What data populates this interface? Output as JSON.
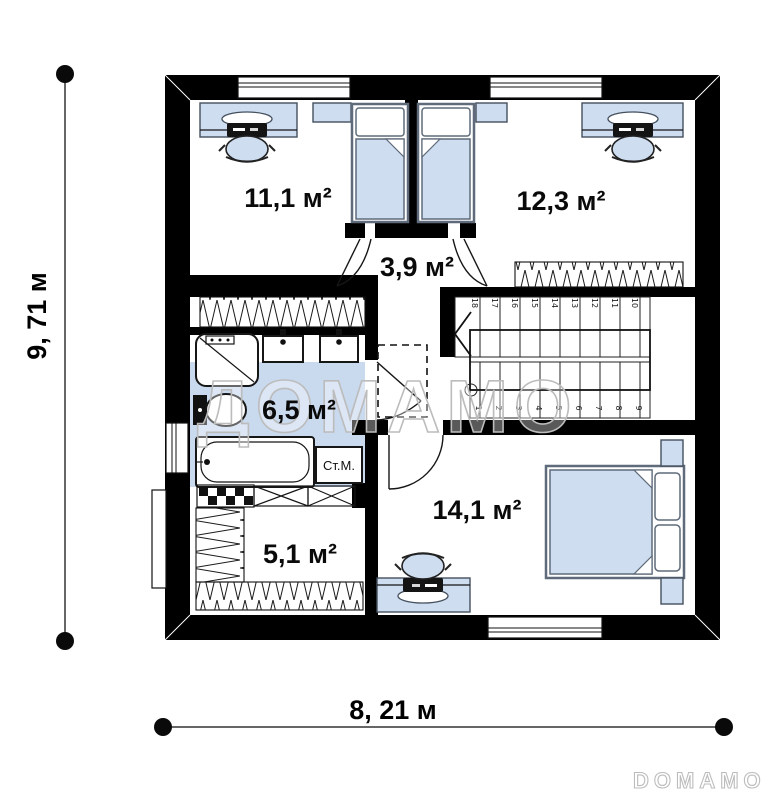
{
  "floor_plan": {
    "rooms": [
      {
        "name": "bedroom-top-left",
        "area": "11,1 м²"
      },
      {
        "name": "bedroom-top-right",
        "area": "12,3 м²"
      },
      {
        "name": "hall",
        "area": "3,9 м²"
      },
      {
        "name": "bathroom",
        "area": "6,5 м²"
      },
      {
        "name": "wardrobe",
        "area": "5,1 м²"
      },
      {
        "name": "bedroom-bottom",
        "area": "14,1 м²"
      }
    ],
    "dimensions": {
      "height": "9, 71 м",
      "width": "8, 21 м"
    },
    "labels": {
      "washing_machine": "Ст.М."
    },
    "stairs": {
      "upper_steps": [
        "18",
        "17",
        "16",
        "15",
        "14",
        "13",
        "12",
        "11",
        "10"
      ],
      "lower_steps": [
        "1",
        "2",
        "3",
        "4",
        "5",
        "6",
        "7",
        "8",
        "9"
      ]
    },
    "watermarks": {
      "center": "ДОМАМО",
      "corner": "DOMAMO"
    },
    "colors": {
      "wall": "#000000",
      "furniture_fill": "#cfddf1",
      "bathroom_floor": "#c9d9ee",
      "furniture_stroke": "#44505e",
      "watermark": "#bcbcbc"
    }
  }
}
